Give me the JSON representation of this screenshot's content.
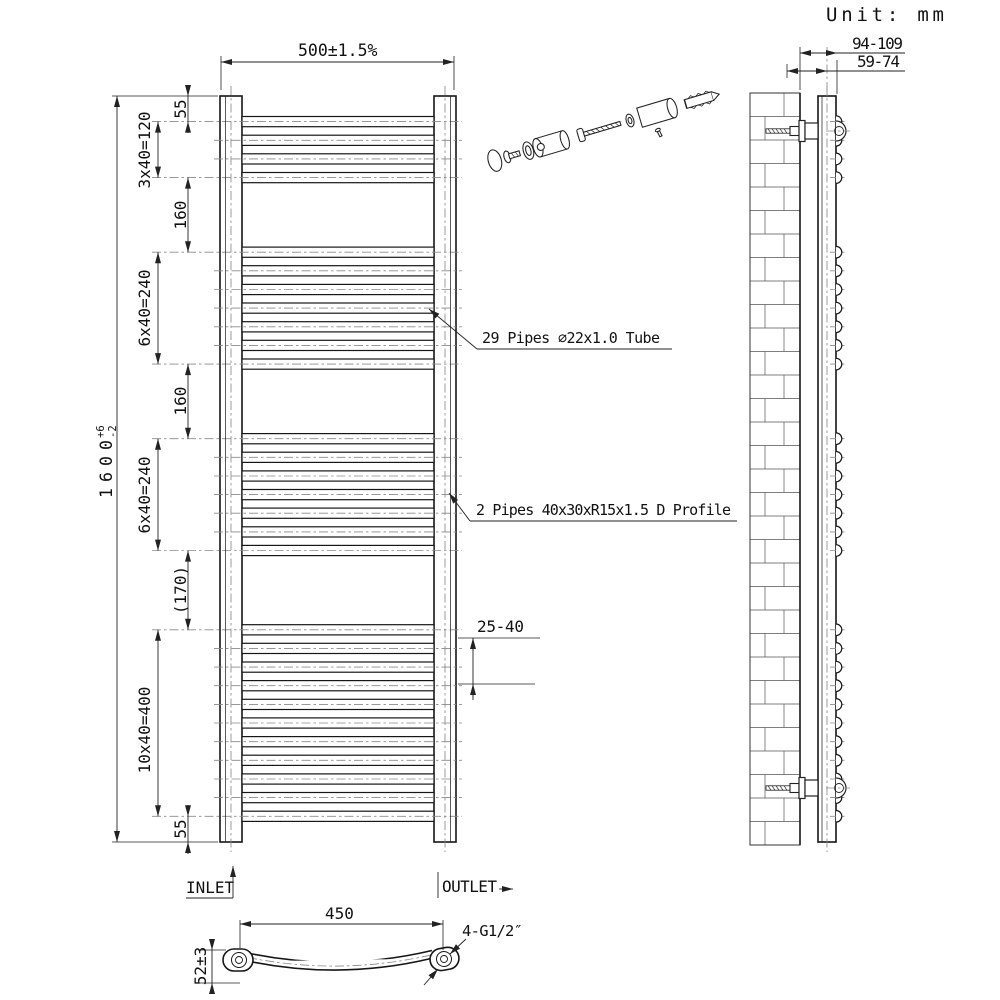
{
  "unit_label": "Unit: mm",
  "front_view": {
    "width_dim": "500±1.5%",
    "height_dim": "1600",
    "height_tol_plus": "+6",
    "height_tol_minus": "-2",
    "left_dims": [
      "55",
      "3x40=120",
      "160",
      "6x40=240",
      "160",
      "6x40=240",
      "(170)",
      "10x40=400",
      "55"
    ],
    "gap_dim": "25-40",
    "pipes_note": "29 Pipes ∅22x1.0 Tube",
    "profile_note": "2 Pipes 40x30xR15x1.5 D Profile",
    "inlet_label": "INLET",
    "outlet_label": "OUTLET",
    "pipe_groups": [
      4,
      7,
      7,
      11
    ],
    "pipe_pitch_mm": 40,
    "group_gaps_mm": [
      160,
      160,
      170
    ]
  },
  "side_view": {
    "depth_dim_total": "94-109",
    "depth_dim_center": "59-74"
  },
  "bottom_view": {
    "centers_dim": "450",
    "depth_dim": "52±3",
    "thread_note": "4-G1/2″"
  }
}
